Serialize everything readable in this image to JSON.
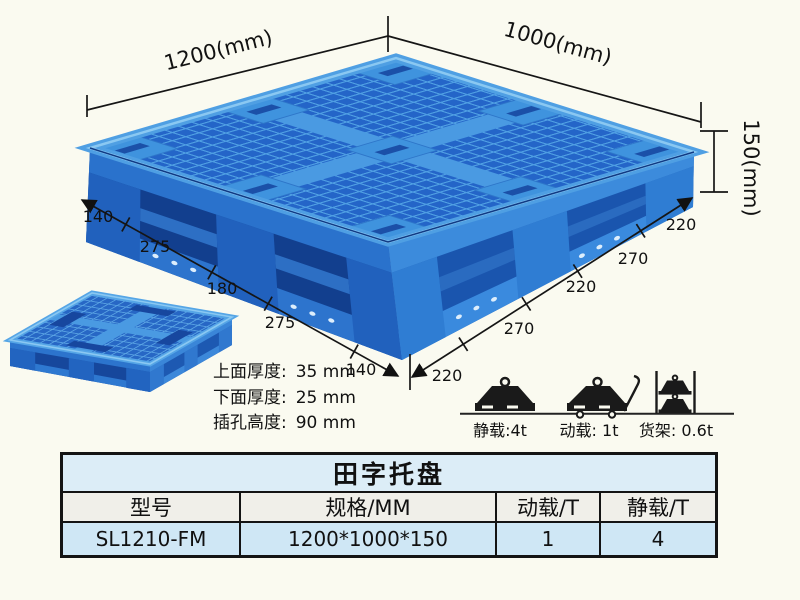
{
  "page": {
    "background": "#fafaf0"
  },
  "illustration": {
    "dims": {
      "length": "1200(mm)",
      "width": "1000(mm)",
      "height": "150(mm)"
    },
    "left_chain": [
      "140",
      "275",
      "180",
      "275",
      "140"
    ],
    "right_chain": [
      "220",
      "270",
      "220",
      "270",
      "220"
    ],
    "notes": [
      {
        "label": "上面厚度:",
        "value": "35 mm"
      },
      {
        "label": "下面厚度:",
        "value": "25 mm"
      },
      {
        "label": "插孔高度:",
        "value": "90 mm"
      }
    ],
    "loads": [
      {
        "icon": "static-load-icon",
        "label": "静载:4t"
      },
      {
        "icon": "dynamic-load-icon",
        "label": "动载: 1t"
      },
      {
        "icon": "rack-load-icon",
        "label": "货架: 0.6t"
      }
    ],
    "pallet_colors": {
      "rib": "#4f9fe3",
      "hole": "#2465c8",
      "side_shadow": "#123f8e",
      "side_lit": "#1a55ae",
      "highlight": "#8ac8f2"
    }
  },
  "table": {
    "title": "田字托盘",
    "headers": [
      "型号",
      "规格/MM",
      "动载/T",
      "静载/T"
    ],
    "row": [
      "SL1210-FM",
      "1200*1000*150",
      "1",
      "4"
    ]
  }
}
